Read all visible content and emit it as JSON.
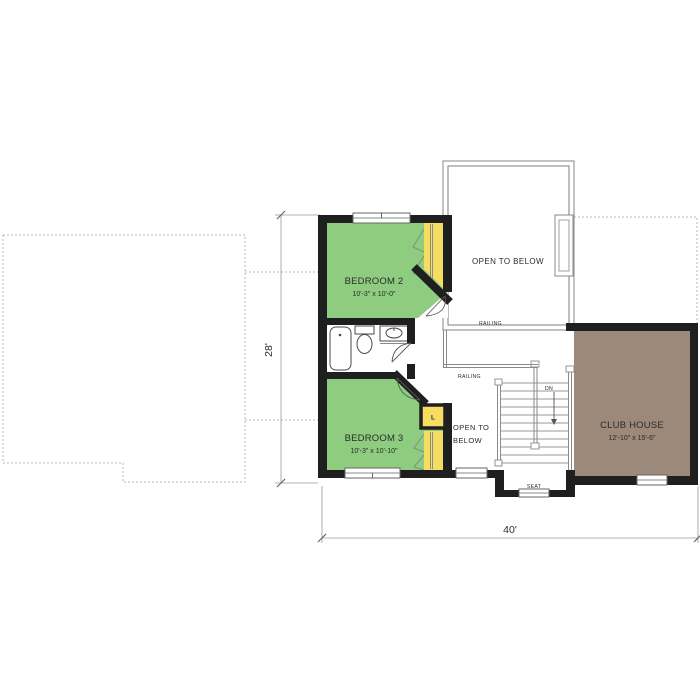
{
  "plan": {
    "rooms": {
      "bedroom2": {
        "name": "BEDROOM 2",
        "size": "10'-3\" x 10'-0\""
      },
      "bedroom3": {
        "name": "BEDROOM 3",
        "size": "10'-3\" x 10'-10\""
      },
      "clubhouse": {
        "name": "CLUB HOUSE",
        "size": "12'-10\" x 15'-6\""
      },
      "open_above": {
        "name": "OPEN TO BELOW"
      },
      "open_lower": {
        "line1": "OPEN TO",
        "line2": "BELOW"
      }
    },
    "labels": {
      "railing_upper": "RAILING",
      "railing_lower": "RAILING",
      "stairs_dn": "DN",
      "seat": "SEAT",
      "linen_closet": "L"
    },
    "dimensions": {
      "overall_width": "40'",
      "overall_depth": "28'"
    },
    "colors": {
      "bedroom_fill": "#8ecd7f",
      "closet_fill": "#f4dd61",
      "clubhouse_fill": "#9c8979",
      "wall": "#1f1f1f"
    }
  }
}
